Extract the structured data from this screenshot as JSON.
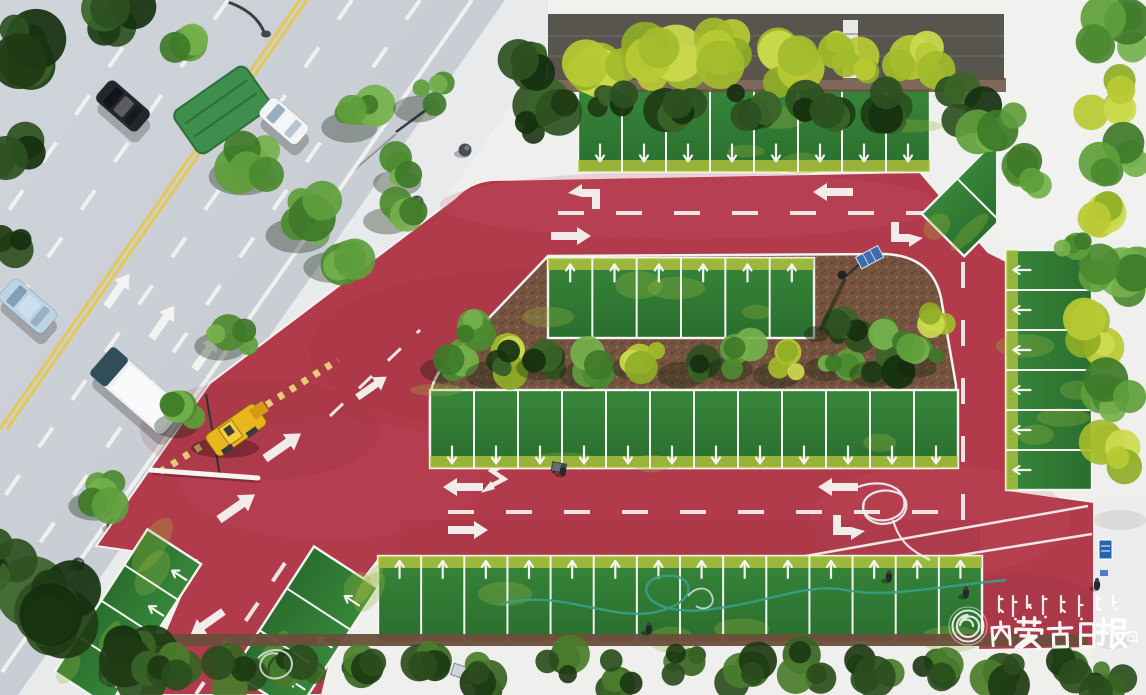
{
  "meta": {
    "type": "aerial-drone-photograph",
    "subject": "Newly built red-paved parking lot with grass parking stalls and tree medians, next to an urban road with traffic"
  },
  "watermark": {
    "publisher_cn": "内蒙古日报",
    "publisher_mn": "ᠥᠪᠥᠷ ᠮᠣᠩᠭᠣᠯ ᠤᠨ ᠡᠳᠦᠷ ᠦᠨ ᠰᠣᠨᠢᠨ",
    "logo": "spiral-seal",
    "text_color": "#ffffff"
  },
  "palette": {
    "red_pavement": "#b23b4b",
    "red_light": "#c85668",
    "red_dark": "#8e2d3c",
    "asphalt": "#c9ced4",
    "sidewalk": "#e9eaeb",
    "stall_green": "#2f7d33",
    "grass_yellow": "#bdca3e",
    "mulch": "#74543f",
    "lane_yellow": "#e6c84e",
    "marking_white": "#f4f4f2",
    "machine_yellow": "#eab61e",
    "hose_teal": "#37a089",
    "sign_blue": "#2563b0",
    "wall_gray": "#57554e"
  },
  "scene": {
    "cars": [
      {
        "name": "dark-car",
        "x": 123,
        "y": 106,
        "w": 27,
        "h": 54,
        "rot": -49,
        "color": "#24262c",
        "glass": "#11131a"
      },
      {
        "name": "white-car",
        "x": 284,
        "y": 121,
        "w": 25,
        "h": 50,
        "rot": -49,
        "color": "#f2f4f6",
        "glass": "#8fa7bb"
      },
      {
        "name": "light-blue-minivan",
        "x": 28,
        "y": 306,
        "w": 28,
        "h": 58,
        "rot": -49,
        "color": "#bdd4e4",
        "glass": "#7d99ad"
      },
      {
        "name": "white-box-truck",
        "x": 137,
        "y": 391,
        "w": 37,
        "h": 96,
        "rot": -49,
        "color": "#eef0f2",
        "glass": "#2f4e59",
        "truck": true
      }
    ],
    "bollards": [
      [
        465,
        150
      ],
      [
        417,
        202
      ],
      [
        366,
        280
      ],
      [
        303,
        330
      ],
      [
        113,
        525
      ],
      [
        78,
        564
      ],
      [
        48,
        610
      ]
    ],
    "people": [
      [
        563,
        471
      ],
      [
        649,
        629
      ],
      [
        889,
        577
      ],
      [
        1097,
        585
      ],
      [
        966,
        593
      ]
    ],
    "parking_rows": [
      {
        "x": 578,
        "y": 88,
        "w": 352,
        "h": 84,
        "n": 8,
        "ay": 0.78,
        "ar": 180,
        "band": "end"
      },
      {
        "x": 548,
        "y": 258,
        "w": 266,
        "h": 80,
        "n": 6,
        "ay": 0.18,
        "ar": 0,
        "band": "start"
      },
      {
        "x": 430,
        "y": 390,
        "w": 528,
        "h": 78,
        "n": 12,
        "ay": 0.84,
        "ar": 180,
        "band": "end"
      },
      {
        "x": 1006,
        "y": 250,
        "w": 86,
        "h": 240,
        "n": 6,
        "v": 1,
        "ax": 0.18,
        "ar": 270,
        "band": "start"
      },
      {
        "x": 378,
        "y": 556,
        "w": 604,
        "h": 86,
        "n": 14,
        "ay": 0.15,
        "ar": 0,
        "band": "start"
      },
      {
        "grp": "rotate(123 128 618)",
        "x": 43,
        "y": 586,
        "w": 170,
        "h": 64,
        "n": 4,
        "ay": 0.2,
        "ar": 180
      },
      {
        "grp": "rotate(123 305 630)",
        "x": 230,
        "y": 592,
        "w": 150,
        "h": 76,
        "n": 3,
        "ay": 0.2,
        "ar": 180
      },
      {
        "grp": "rotate(-45 996 182)",
        "x": 921,
        "y": 152,
        "w": 150,
        "h": 60,
        "n": 3,
        "na": 1
      }
    ],
    "dashes": [
      {
        "layer": "road",
        "x1": 300,
        "y1": 0,
        "x2": 0,
        "y2": 429,
        "c": "y",
        "w": 3.2
      },
      {
        "layer": "road",
        "x1": 307,
        "y1": 0,
        "x2": 7,
        "y2": 429,
        "c": "y",
        "w": 3.2
      },
      {
        "layer": "road",
        "x1": 352,
        "y1": 0,
        "x2": 0,
        "y2": 503,
        "da": "24 34"
      },
      {
        "layer": "road",
        "x1": 420,
        "y1": 0,
        "x2": 0,
        "y2": 600,
        "da": "24 34"
      },
      {
        "layer": "road",
        "x1": 228,
        "y1": 0,
        "x2": 0,
        "y2": 326,
        "da": "24 34"
      },
      {
        "layer": "road",
        "x1": 156,
        "y1": 0,
        "x2": 0,
        "y2": 223,
        "da": "24 34"
      },
      {
        "layer": "road",
        "x1": 472,
        "y1": 0,
        "x2": 2,
        "y2": 672,
        "w": 4
      },
      {
        "layer": "red",
        "x1": 558,
        "y1": 213,
        "x2": 1050,
        "y2": 213,
        "da": "26 32"
      },
      {
        "layer": "red",
        "x1": 963,
        "y1": 262,
        "x2": 963,
        "y2": 548,
        "da": "26 32"
      },
      {
        "layer": "red",
        "x1": 448,
        "y1": 512,
        "x2": 950,
        "y2": 512,
        "da": "26 32"
      },
      {
        "layer": "red",
        "x1": 285,
        "y1": 563,
        "x2": 196,
        "y2": 694,
        "da": "22 26"
      },
      {
        "layer": "red",
        "x1": 330,
        "y1": 416,
        "x2": 420,
        "y2": 330,
        "w": 3,
        "da": "18 22"
      },
      {
        "layer": "red",
        "x1": 800,
        "y1": 557,
        "x2": 1088,
        "y2": 506,
        "w": 2.5
      },
      {
        "layer": "red",
        "x1": 836,
        "y1": 575,
        "x2": 1092,
        "y2": 534,
        "w": 2.5
      }
    ],
    "arrows": [
      {
        "layer": "road",
        "t": "left",
        "x": 118,
        "y": 290,
        "r": 125
      },
      {
        "layer": "road",
        "t": "left",
        "x": 163,
        "y": 322,
        "r": 125
      },
      {
        "layer": "road",
        "t": "left",
        "x": 206,
        "y": 353,
        "r": 125
      },
      {
        "layer": "red",
        "t": "bentL",
        "x": 588,
        "y": 193,
        "r": 0
      },
      {
        "layer": "red",
        "t": "left",
        "x": 833,
        "y": 192,
        "r": 0
      },
      {
        "layer": "red",
        "t": "left",
        "x": 571,
        "y": 236,
        "r": 180
      },
      {
        "layer": "red",
        "t": "bentL",
        "x": 903,
        "y": 238,
        "r": 180
      },
      {
        "layer": "red",
        "t": "zig",
        "x": 497,
        "y": 477,
        "r": 0
      },
      {
        "layer": "red",
        "t": "left",
        "x": 463,
        "y": 487,
        "r": 0
      },
      {
        "layer": "red",
        "t": "left",
        "x": 838,
        "y": 487,
        "r": 0
      },
      {
        "layer": "red",
        "t": "left",
        "x": 468,
        "y": 530,
        "r": 180
      },
      {
        "layer": "red",
        "t": "bentL",
        "x": 845,
        "y": 531,
        "r": 180
      },
      {
        "layer": "red",
        "t": "left",
        "x": 283,
        "y": 446,
        "r": 145,
        "s": 1.1
      },
      {
        "layer": "red",
        "t": "left",
        "x": 237,
        "y": 507,
        "r": 145,
        "s": 1.1
      },
      {
        "layer": "red",
        "t": "left",
        "x": 372,
        "y": 387,
        "r": 145,
        "s": 0.9
      },
      {
        "layer": "red",
        "t": "left",
        "x": 207,
        "y": 623,
        "r": 325
      },
      {
        "layer": "red",
        "t": "zig",
        "x": 224,
        "y": 657,
        "r": 325,
        "s": 0.9
      },
      {
        "layer": "red",
        "t": "left",
        "x": 958,
        "y": 185,
        "r": 315,
        "s": 0.6
      },
      {
        "layer": "red",
        "t": "left",
        "x": 988,
        "y": 215,
        "r": 315,
        "s": 0.6
      }
    ],
    "trees": [
      [
        28,
        45,
        42,
        6,
        "dark"
      ],
      [
        10,
        150,
        36,
        5,
        "dark"
      ],
      [
        6,
        250,
        28,
        4,
        "dark"
      ],
      [
        120,
        18,
        30,
        5,
        "dark"
      ],
      [
        185,
        52,
        26,
        4,
        "mid"
      ],
      [
        258,
        158,
        34,
        6,
        "mid",
        1
      ],
      [
        312,
        218,
        32,
        5,
        "mid",
        1
      ],
      [
        362,
        112,
        28,
        5,
        "mid",
        1
      ],
      [
        408,
        170,
        24,
        4,
        "mid",
        1
      ],
      [
        428,
        96,
        24,
        4,
        "mid",
        1
      ],
      [
        232,
        332,
        26,
        4,
        "mid",
        1
      ],
      [
        186,
        414,
        22,
        4,
        "mid",
        1
      ],
      [
        106,
        492,
        26,
        5,
        "mid",
        1
      ],
      [
        42,
        612,
        48,
        8,
        "dark"
      ],
      [
        128,
        664,
        40,
        7,
        "dark"
      ],
      [
        10,
        560,
        30,
        5,
        "dark"
      ],
      [
        344,
        252,
        28,
        5,
        "mid",
        1
      ],
      [
        398,
        208,
        24,
        4,
        "mid",
        1
      ],
      [
        452,
        358,
        22,
        4,
        "mid",
        1
      ],
      [
        500,
        362,
        24,
        4,
        "bright",
        1
      ],
      [
        548,
        356,
        22,
        4,
        "dark",
        1
      ],
      [
        596,
        362,
        25,
        4,
        "mid",
        1
      ],
      [
        644,
        356,
        22,
        4,
        "bright",
        1
      ],
      [
        692,
        362,
        24,
        4,
        "dark",
        1
      ],
      [
        740,
        357,
        23,
        4,
        "mid",
        1
      ],
      [
        788,
        362,
        24,
        4,
        "bright",
        1
      ],
      [
        836,
        357,
        22,
        4,
        "mid",
        1
      ],
      [
        884,
        361,
        24,
        4,
        "dark",
        1
      ],
      [
        926,
        356,
        20,
        4,
        "mid",
        1
      ],
      [
        468,
        332,
        24,
        4,
        "mid"
      ],
      [
        508,
        362,
        20,
        4,
        "dark"
      ],
      [
        848,
        328,
        24,
        5,
        "dark"
      ],
      [
        898,
        336,
        26,
        5,
        "mid"
      ],
      [
        934,
        316,
        20,
        4,
        "bright"
      ],
      [
        600,
        58,
        34,
        6,
        "bright"
      ],
      [
        662,
        64,
        38,
        6,
        "bright"
      ],
      [
        726,
        52,
        34,
        6,
        "bright"
      ],
      [
        788,
        66,
        36,
        6,
        "bright"
      ],
      [
        852,
        56,
        32,
        6,
        "bright"
      ],
      [
        916,
        64,
        34,
        6,
        "bright"
      ],
      [
        965,
        106,
        30,
        5,
        "dark"
      ],
      [
        612,
        108,
        26,
        5,
        "dark"
      ],
      [
        680,
        116,
        30,
        5,
        "dark"
      ],
      [
        752,
        104,
        26,
        5,
        "dark"
      ],
      [
        822,
        114,
        30,
        5,
        "dark"
      ],
      [
        892,
        106,
        26,
        5,
        "dark"
      ],
      [
        545,
        118,
        32,
        6,
        "dark"
      ],
      [
        520,
        68,
        28,
        5,
        "dark"
      ],
      [
        995,
        125,
        30,
        5,
        "mid"
      ],
      [
        1022,
        172,
        26,
        5,
        "mid"
      ],
      [
        1112,
        35,
        36,
        6,
        "mid"
      ],
      [
        1104,
        95,
        32,
        5,
        "bright"
      ],
      [
        1118,
        155,
        34,
        6,
        "mid"
      ],
      [
        1100,
        215,
        30,
        5,
        "bright"
      ],
      [
        1116,
        275,
        34,
        6,
        "mid"
      ],
      [
        1102,
        335,
        32,
        5,
        "bright"
      ],
      [
        1118,
        395,
        30,
        5,
        "mid"
      ],
      [
        1106,
        455,
        30,
        5,
        "bright"
      ],
      [
        1070,
        240,
        22,
        4,
        "mid"
      ],
      [
        170,
        664,
        26,
        5,
        "bush"
      ],
      [
        234,
        672,
        28,
        5,
        "bush"
      ],
      [
        298,
        662,
        26,
        5,
        "bush"
      ],
      [
        362,
        674,
        28,
        5,
        "bush"
      ],
      [
        426,
        664,
        26,
        5,
        "bush"
      ],
      [
        490,
        676,
        28,
        5,
        "bush"
      ],
      [
        554,
        664,
        26,
        5,
        "bush"
      ],
      [
        618,
        674,
        28,
        5,
        "bush"
      ],
      [
        682,
        663,
        26,
        5,
        "bush"
      ],
      [
        746,
        675,
        28,
        5,
        "bush"
      ],
      [
        810,
        664,
        26,
        5,
        "bush"
      ],
      [
        874,
        674,
        28,
        5,
        "bush"
      ],
      [
        938,
        665,
        26,
        5,
        "bush"
      ],
      [
        1002,
        676,
        28,
        5,
        "bush"
      ],
      [
        1066,
        666,
        26,
        5,
        "bush"
      ],
      [
        1110,
        682,
        24,
        5,
        "bush"
      ]
    ],
    "mongolian_marks": [
      [
        999,
        16,
        0
      ],
      [
        1013,
        20,
        1
      ],
      [
        1027,
        12,
        0
      ],
      [
        1043,
        18,
        1
      ],
      [
        1061,
        16,
        0
      ],
      [
        1079,
        20,
        1
      ],
      [
        1097,
        14,
        0
      ],
      [
        1113,
        10,
        1
      ]
    ]
  }
}
